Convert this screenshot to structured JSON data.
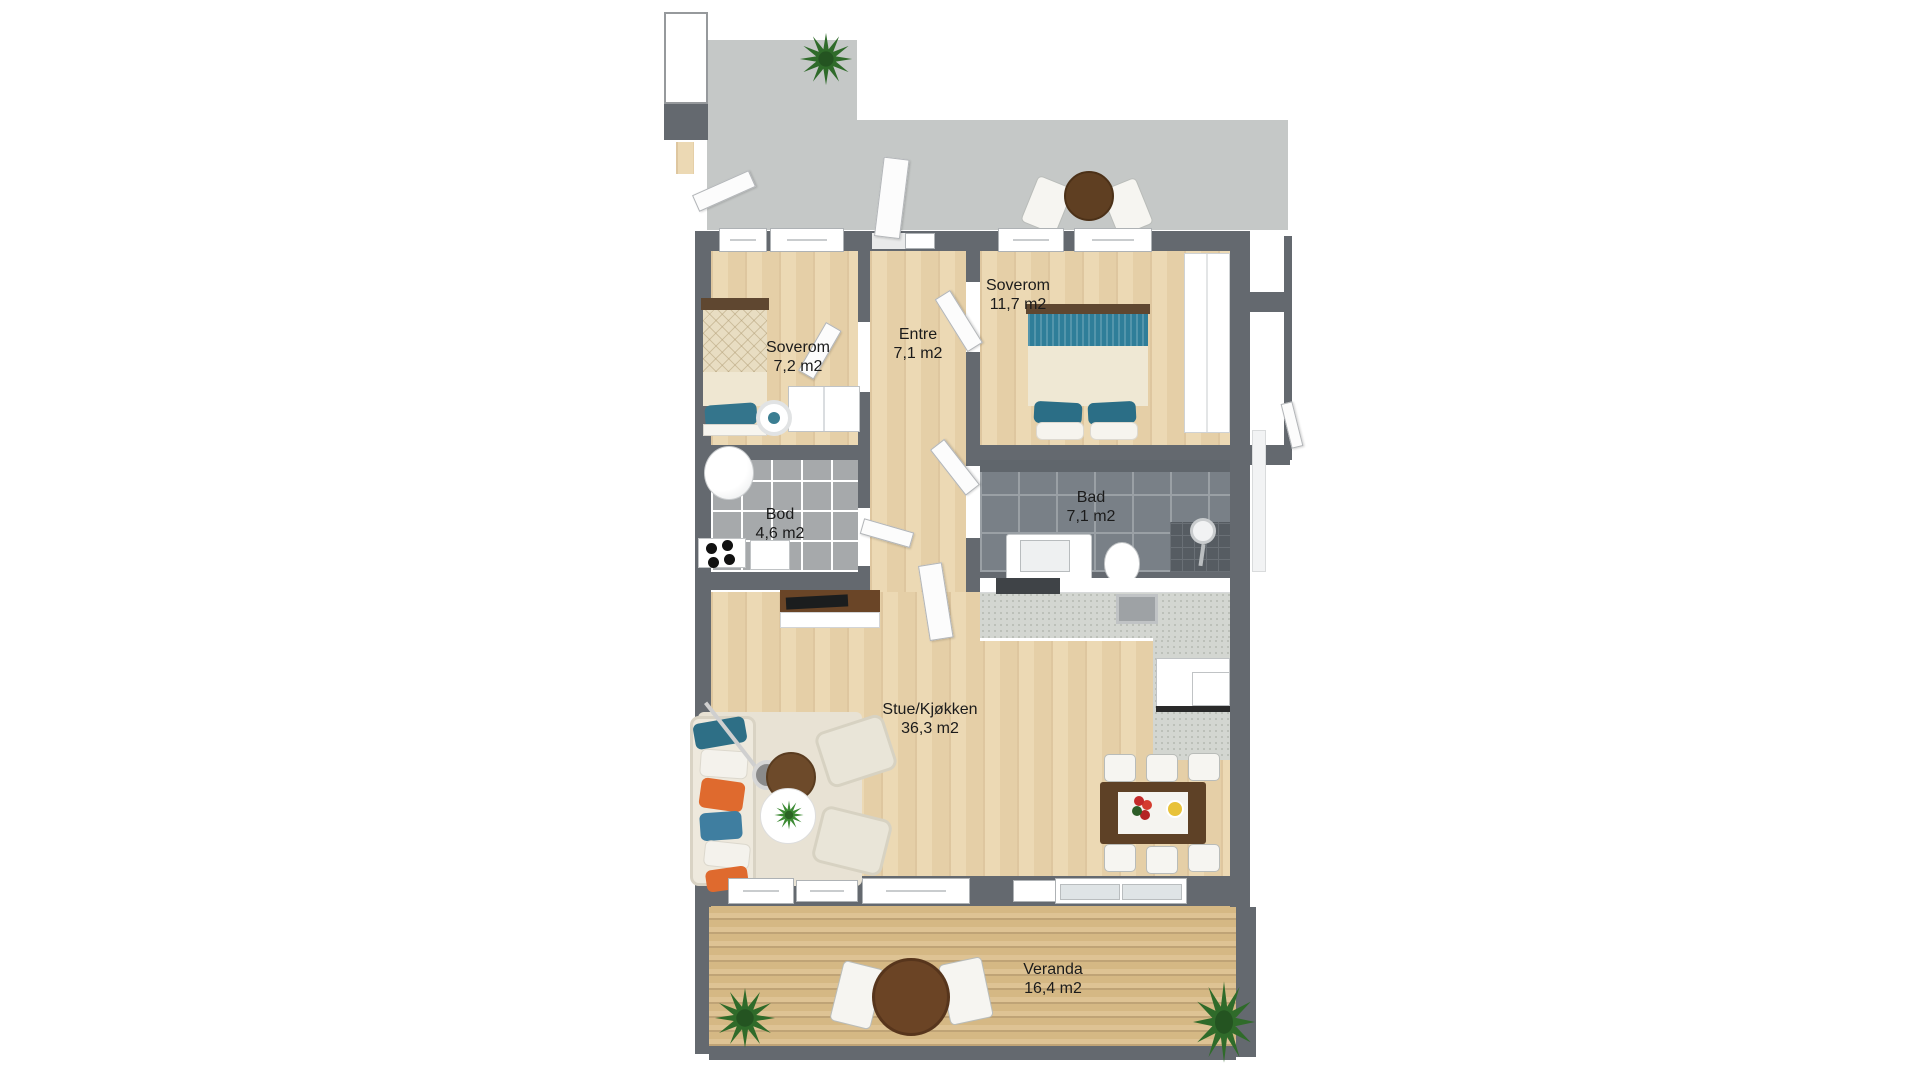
{
  "floorplan": {
    "rooms": [
      {
        "name": "Soverom",
        "area": "7,2 m2"
      },
      {
        "name": "Entre",
        "area": "7,1 m2"
      },
      {
        "name": "Soverom",
        "area": "11,7 m2"
      },
      {
        "name": "Bod",
        "area": "4,6 m2"
      },
      {
        "name": "Bad",
        "area": "7,1 m2"
      },
      {
        "name": "Stue/Kjøkken",
        "area": "36,3 m2"
      },
      {
        "name": "Veranda",
        "area": "16,4 m2"
      }
    ],
    "colors": {
      "wall": "#64696f",
      "walkway": "#c5c8c7",
      "wood_floor": "#e9d4ae",
      "deck": "#d9bd8d",
      "tile_light": "#a6a9ab",
      "tile_dark": "#798087",
      "accent_teal": "#2f7e99",
      "accent_orange": "#df6a2e",
      "furniture_wood": "#6b4527"
    }
  }
}
